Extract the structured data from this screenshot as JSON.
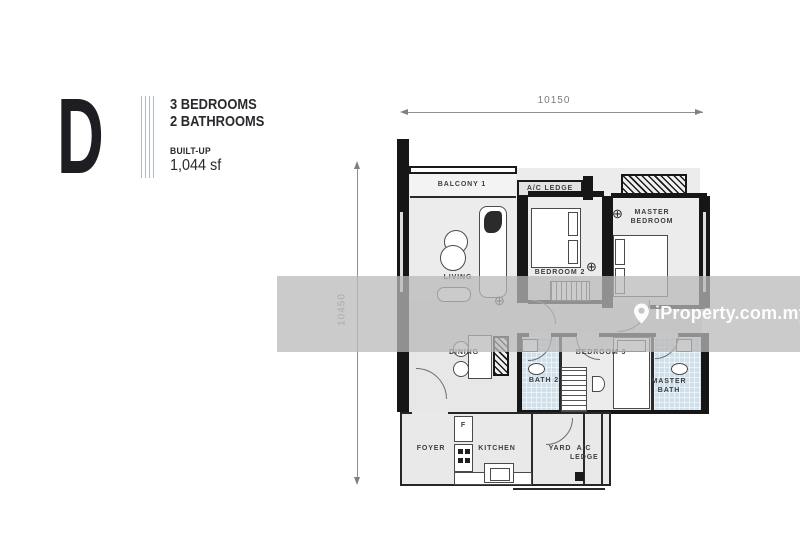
{
  "panel": {
    "unit": "D",
    "line1": "3 BEDROOMS",
    "line2": "2 BATHROOMS",
    "built_up_label": "BUILT-UP",
    "built_up_value": "1,044 sf"
  },
  "dimensions": {
    "width": "10150",
    "height": "10450"
  },
  "watermark": {
    "text": "iProperty.com.my"
  },
  "symbols": {
    "fan": "⊕"
  },
  "rooms": {
    "balcony1": "BALCONY 1",
    "ac_ledge_top": "A/C LEDGE",
    "living": "LIVING",
    "bedroom2": "BEDROOM 2",
    "master_bedroom": "MASTER BEDROOM",
    "dining": "DINING",
    "bath2": "BATH 2",
    "bedroom3": "BEDROOM 3",
    "master_bath": "MASTER BATH",
    "foyer": "FOYER",
    "kitchen": "KITCHEN",
    "yard": "YARD",
    "ac_ledge_bottom": "A/C LEDGE",
    "fridge": "F"
  },
  "colors": {
    "wall": "#161616",
    "floor": "#ececec",
    "bath_tile": "#cfe0ea",
    "watermark_band": "#bababa",
    "text": "#2a2a2e"
  }
}
